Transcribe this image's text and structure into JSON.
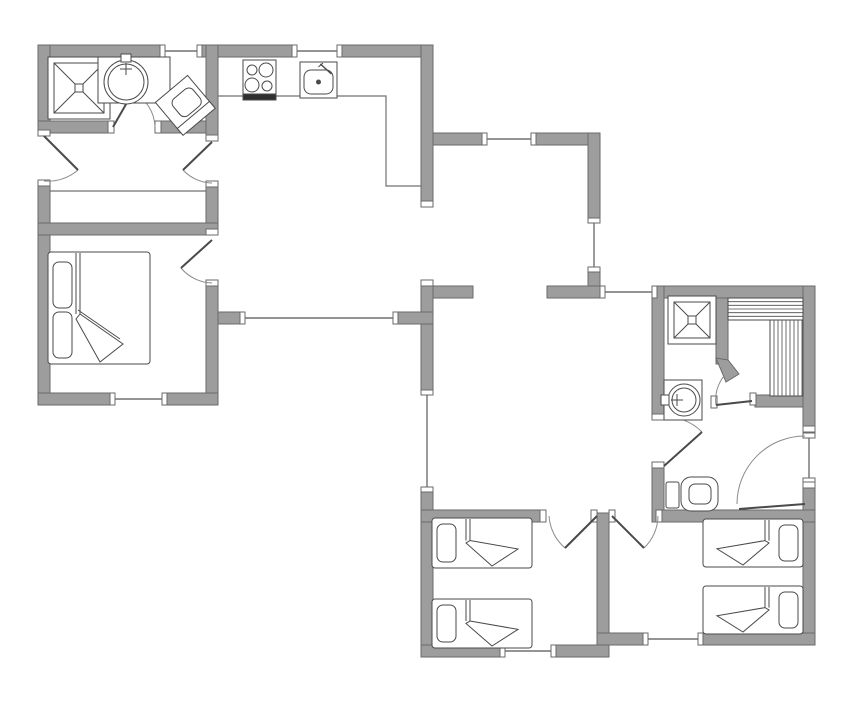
{
  "title": "house-floor-plan",
  "canvas": {
    "width": 849,
    "height": 714,
    "background": "#ffffff"
  },
  "colors": {
    "wall_fill": "#9d9d9d",
    "wall_stroke": "#6a6a6a",
    "fixture_stroke": "#4a4a4a",
    "thin_line": "#707070",
    "dark_fill": "#2f2f2f",
    "white": "#ffffff"
  },
  "walls": [
    [
      38,
      45,
      122,
      12
    ],
    [
      200,
      45,
      93,
      12
    ],
    [
      340,
      45,
      93,
      12
    ],
    [
      38,
      45,
      12,
      88
    ],
    [
      38,
      182,
      12,
      223
    ],
    [
      38,
      121,
      75,
      12
    ],
    [
      158,
      121,
      60,
      12
    ],
    [
      206,
      45,
      12,
      96
    ],
    [
      206,
      183,
      12,
      52
    ],
    [
      38,
      223,
      180,
      12
    ],
    [
      206,
      282,
      12,
      123
    ],
    [
      38,
      393,
      77,
      12
    ],
    [
      162,
      393,
      56,
      12
    ],
    [
      421,
      45,
      12,
      162
    ],
    [
      433,
      133,
      54,
      12
    ],
    [
      531,
      133,
      69,
      12
    ],
    [
      588,
      133,
      12,
      90
    ],
    [
      588,
      267,
      12,
      31
    ],
    [
      547,
      286,
      58,
      12
    ],
    [
      421,
      286,
      52,
      12
    ],
    [
      421,
      286,
      12,
      109
    ],
    [
      421,
      487,
      12,
      170
    ],
    [
      218,
      312,
      27,
      12
    ],
    [
      393,
      312,
      40,
      12
    ],
    [
      652,
      286,
      163,
      12
    ],
    [
      652,
      286,
      12,
      134
    ],
    [
      652,
      468,
      12,
      54
    ],
    [
      716,
      298,
      12,
      66
    ],
    [
      755,
      395,
      60,
      12
    ],
    [
      803,
      286,
      12,
      146
    ],
    [
      803,
      488,
      12,
      157
    ],
    [
      662,
      510,
      153,
      12
    ],
    [
      421,
      510,
      124,
      12
    ],
    [
      597,
      513,
      12,
      137
    ],
    [
      421,
      645,
      84,
      12
    ],
    [
      551,
      645,
      58,
      12
    ],
    [
      597,
      633,
      51,
      12
    ],
    [
      698,
      633,
      117,
      12
    ]
  ],
  "wall_polys": [
    [
      [
        716,
        358
      ],
      [
        728,
        360
      ],
      [
        739,
        374
      ],
      [
        726,
        382
      ]
    ]
  ],
  "windows": [
    [
      165,
      51,
      197,
      51
    ],
    [
      297,
      51,
      337,
      51
    ],
    [
      487,
      139,
      531,
      139
    ],
    [
      594,
      223,
      594,
      267
    ],
    [
      605,
      292,
      652,
      292
    ],
    [
      427,
      395,
      427,
      487
    ],
    [
      245,
      318,
      393,
      318
    ],
    [
      115,
      399,
      162,
      399
    ],
    [
      505,
      651,
      551,
      651
    ],
    [
      648,
      639,
      698,
      639
    ],
    [
      809,
      438,
      809,
      478
    ]
  ],
  "caps": [
    [
      38,
      130,
      12,
      6
    ],
    [
      38,
      180,
      12,
      6
    ],
    [
      206,
      135,
      12,
      6
    ],
    [
      206,
      181,
      12,
      6
    ],
    [
      206,
      229,
      12,
      6
    ],
    [
      206,
      280,
      12,
      6
    ],
    [
      108,
      121,
      6,
      12
    ],
    [
      155,
      121,
      6,
      12
    ],
    [
      540,
      510,
      6,
      12
    ],
    [
      591,
      510,
      6,
      12
    ],
    [
      609,
      510,
      6,
      12
    ],
    [
      656,
      510,
      6,
      12
    ],
    [
      652,
      414,
      12,
      6
    ],
    [
      652,
      462,
      12,
      6
    ],
    [
      803,
      426,
      12,
      6
    ],
    [
      803,
      482,
      12,
      6
    ],
    [
      750,
      393,
      6,
      12
    ],
    [
      711,
      396,
      6,
      12
    ],
    [
      421,
      201,
      12,
      6
    ],
    [
      421,
      280,
      12,
      6
    ]
  ],
  "doors": [
    {
      "name": "entry-door-west",
      "leaf": [
        44,
        136,
        78,
        170
      ],
      "arc": "M 44 181 A 46 46 0 0 0 78 170"
    },
    {
      "name": "utility-room-door",
      "leaf": [
        113,
        127,
        133,
        92
      ],
      "arc": "M 155 127 A 41 41 0 0 0 133 92"
    },
    {
      "name": "kitchen-hall-door",
      "leaf": [
        212,
        142,
        183,
        170
      ],
      "arc": "M 212 183 A 41 41 0 0 1 183 170"
    },
    {
      "name": "master-bedroom-door",
      "leaf": [
        212,
        240,
        181,
        268
      ],
      "arc": "M 212 283 A 42 42 0 0 1 181 268"
    },
    {
      "name": "bathroom-door",
      "leaf": [
        664,
        466,
        702,
        432
      ],
      "arc": "M 664 417 A 50 50 0 0 1 702 432"
    },
    {
      "name": "sauna-door",
      "leaf": [
        752,
        401,
        716,
        405
      ],
      "arc": "M 724 376 A 38 38 0 0 0 716 405"
    },
    {
      "name": "entry-door-east",
      "leaf": [
        805,
        504,
        739,
        509
      ],
      "arc": "M 737 504 A 68 68 0 0 1 805 436"
    },
    {
      "name": "bedroom-left-door",
      "leaf": [
        597,
        516,
        565,
        548
      ],
      "arc": "M 549 516 A 46 46 0 0 0 565 548"
    },
    {
      "name": "bedroom-right-door",
      "leaf": [
        612,
        516,
        644,
        548
      ],
      "arc": "M 658 516 A 45 45 0 0 1 644 548"
    }
  ],
  "counters": [
    [
      [
        218,
        96
      ],
      [
        386,
        96
      ],
      [
        386,
        186
      ],
      [
        433,
        186
      ]
    ]
  ],
  "thin_lines": [
    [
      50,
      191,
      206,
      191
    ]
  ],
  "fixtures": [
    {
      "type": "shower",
      "name": "shower-utility",
      "x": 48,
      "y": 57,
      "s": 62
    },
    {
      "type": "shower",
      "name": "shower-bathroom",
      "x": 668,
      "y": 296,
      "s": 48
    },
    {
      "type": "basin",
      "name": "basin-utility",
      "x": 98,
      "y": 57,
      "w": 72,
      "h": 46,
      "cx": 126,
      "cy": 82,
      "r": 22,
      "faucet": "top"
    },
    {
      "type": "basin",
      "name": "basin-bathroom",
      "x": 664,
      "y": 380,
      "w": 38,
      "h": 40,
      "cx": 684,
      "cy": 400,
      "r": 16,
      "faucet": "left"
    },
    {
      "type": "toiletAngled",
      "name": "toilet-utility",
      "cx": 185,
      "cy": 105,
      "rot": -40
    },
    {
      "type": "toilet",
      "name": "toilet-wc",
      "x": 666,
      "y": 477
    },
    {
      "type": "stove",
      "name": "stove",
      "x": 243,
      "y": 60,
      "w": 33,
      "h": 40
    },
    {
      "type": "ksink",
      "name": "kitchen-sink",
      "x": 300,
      "y": 62,
      "w": 37,
      "h": 36
    },
    {
      "type": "bedDouble",
      "name": "double-bed",
      "x": 48,
      "y": 252,
      "w": 102,
      "h": 112
    },
    {
      "type": "bedSingle",
      "name": "single-bed-1",
      "x": 432,
      "y": 518,
      "w": 100,
      "h": 50,
      "head": "left"
    },
    {
      "type": "bedSingle",
      "name": "single-bed-2",
      "x": 432,
      "y": 599,
      "w": 100,
      "h": 49,
      "head": "left"
    },
    {
      "type": "bedSingle",
      "name": "single-bed-3",
      "x": 703,
      "y": 519,
      "w": 100,
      "h": 48,
      "head": "right"
    },
    {
      "type": "bedSingle",
      "name": "single-bed-4",
      "x": 703,
      "y": 586,
      "w": 100,
      "h": 48,
      "head": "right"
    },
    {
      "type": "saunaH",
      "name": "sauna-bench-top",
      "x": 728,
      "y": 298,
      "w": 75,
      "h": 22,
      "lines": 6
    },
    {
      "type": "saunaV",
      "name": "sauna-bench-side",
      "x": 770,
      "y": 320,
      "w": 33,
      "h": 76,
      "step": 4
    }
  ]
}
